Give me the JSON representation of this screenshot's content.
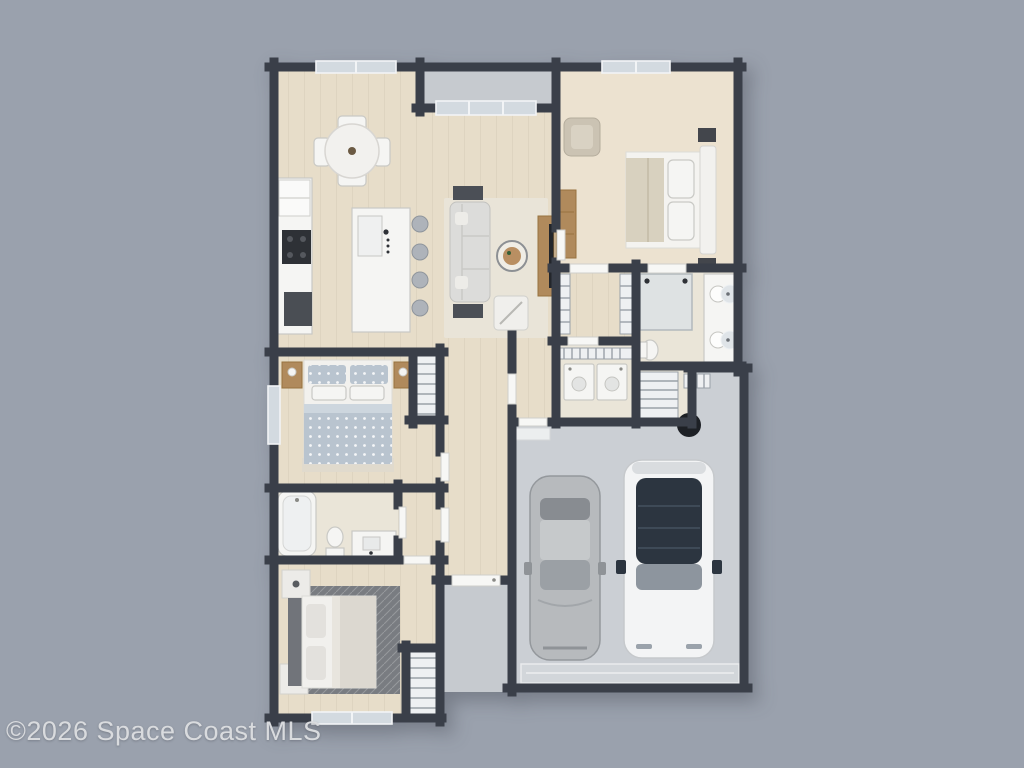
{
  "watermark": {
    "text": "©2026 Space Coast MLS"
  },
  "scene": {
    "type": "3d-top-down-floor-plan-render",
    "rooms": [
      "dining-room",
      "kitchen",
      "living-room",
      "patio",
      "master-bedroom",
      "walk-in-closet",
      "master-bathroom",
      "laundry-room",
      "hallway",
      "foyer",
      "bedroom-2",
      "closet-2",
      "bathroom-2",
      "vestibule",
      "bedroom-3",
      "closet-3",
      "garage",
      "entry-walk"
    ],
    "objects": [
      "dining-table",
      "dining-chairs",
      "kitchen-island",
      "bar-stools",
      "refrigerator",
      "cooktop",
      "oven",
      "sofa",
      "coffee-table",
      "armchair",
      "tv-console",
      "master-bed",
      "dresser",
      "accent-chair",
      "double-vanity",
      "shower",
      "washer",
      "dryer",
      "wire-shelving",
      "water-heater",
      "bed-2",
      "nightstands",
      "bathtub",
      "toilet",
      "vanity-2",
      "bed-3",
      "area-rug",
      "silver-sedan",
      "white-suv",
      "garage-door",
      "front-door",
      "sliding-glass-door",
      "windows"
    ]
  },
  "colors": {
    "bg": "#9aa1ad",
    "wall": "#3a3f49",
    "wood": "#e7ddc9",
    "wood-light": "#ece2d0",
    "tile": "#eae5d8",
    "concrete": "#c6cacf",
    "garage": "#cbcfd4",
    "white": "#f5f5f3",
    "fixture-stroke": "#c9c9c5",
    "sofa": "#dcdcda",
    "wood-furn": "#b08a5c",
    "dark": "#23262b",
    "glass": "#d3dae0",
    "shelf": "#eef0f2",
    "shelf-line": "#9aa1a8",
    "rug-dark": "#797c81",
    "duvet": "#b9c4cf",
    "car-silver": "#b7babd",
    "car-white": "#f3f4f5",
    "car-glass": "#2c3540",
    "watermark": "#d9dbde"
  }
}
